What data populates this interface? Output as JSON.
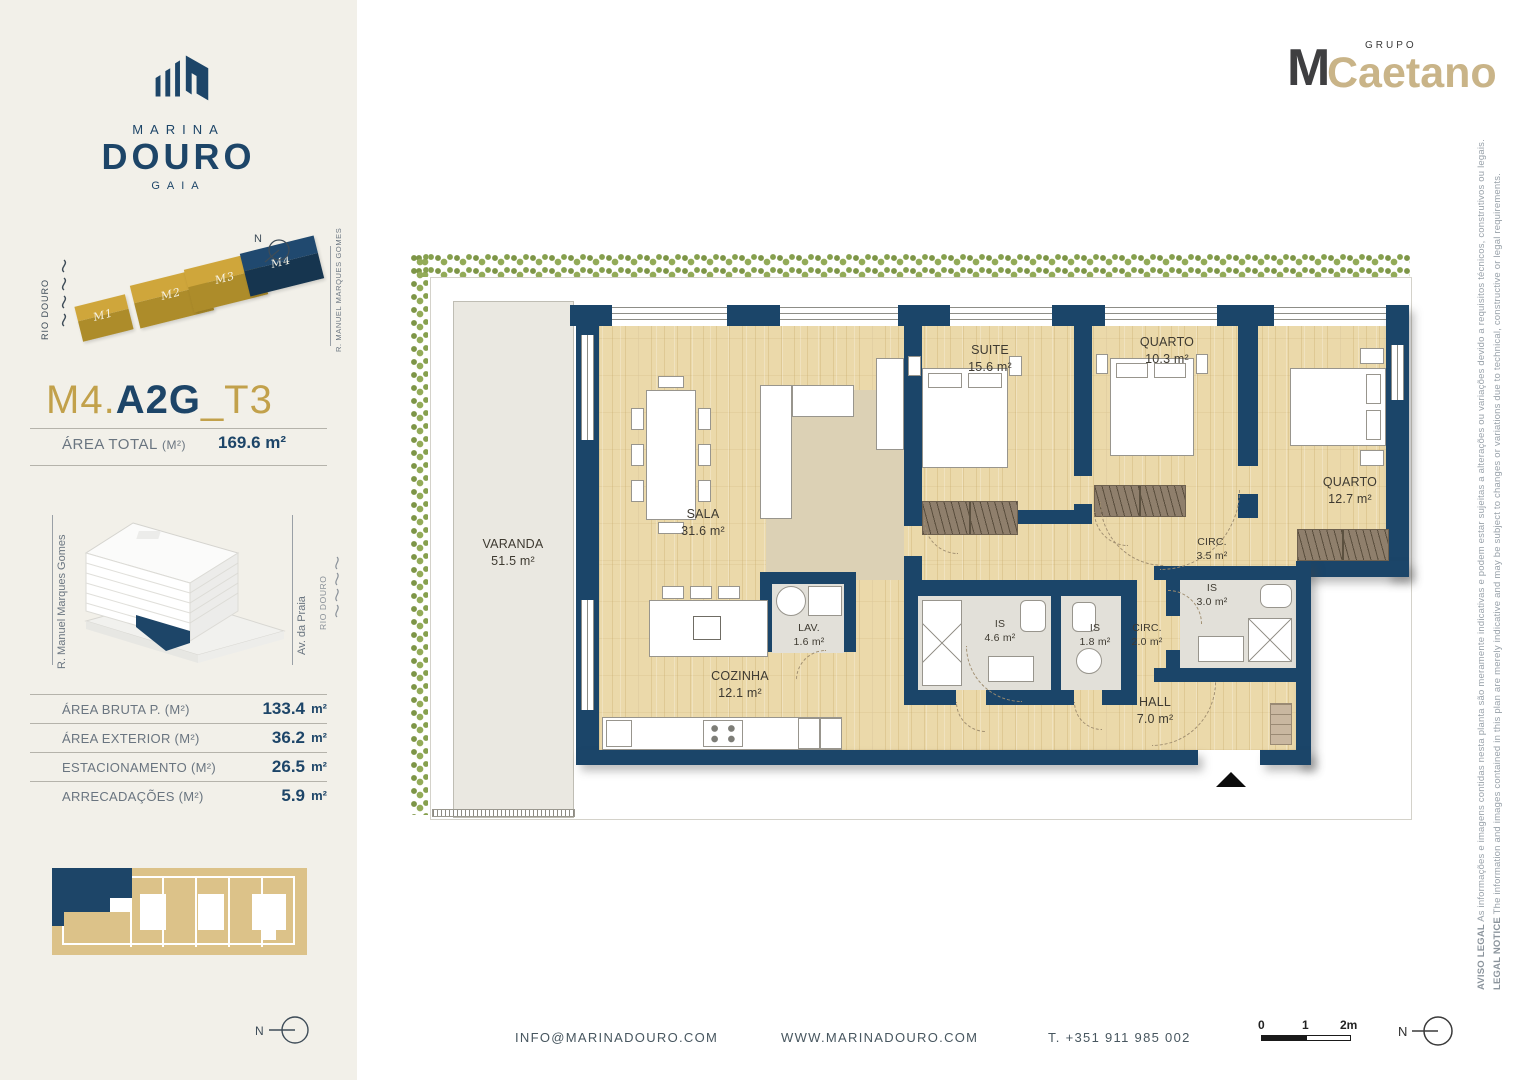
{
  "brand": {
    "name_top": "MARINA",
    "name_main": "DOURO",
    "name_sub": "GAIA"
  },
  "group_logo": {
    "top": "GRUPO",
    "m": "M",
    "name": "Caetano"
  },
  "sidebar": {
    "site_diagram": {
      "river": "RIO DOURO",
      "street": "R. MANUEL MARQUES GOMES",
      "north": "N",
      "blocks": [
        {
          "label": "M1"
        },
        {
          "label": "M2"
        },
        {
          "label": "M3"
        },
        {
          "label": "M4"
        }
      ]
    },
    "unit_title": {
      "prefix": "M4.",
      "main": "A2G",
      "suffix": "_T3"
    },
    "area_total": {
      "label": "ÁREA TOTAL",
      "note": "(M²)",
      "value": "169.6 m²"
    },
    "building_diagram": {
      "street_left": "R. Manuel Marques Gomes",
      "street_right": "Av. da Praia",
      "river": "RIO DOURO"
    },
    "areas_table": [
      {
        "label": "ÁREA BRUTA P.  (M²)",
        "value": "133.4",
        "unit": "m²"
      },
      {
        "label": "ÁREA EXTERIOR (M²)",
        "value": "36.2",
        "unit": "m²"
      },
      {
        "label": "ESTACIONAMENTO (M²)",
        "value": "26.5",
        "unit": "m²"
      },
      {
        "label": "ARRECADAÇÕES (M²)",
        "value": "5.9",
        "unit": "m²"
      }
    ],
    "north": "N"
  },
  "floorplan": {
    "rooms": {
      "varanda": {
        "name": "VARANDA",
        "area": "51.5 m²"
      },
      "sala": {
        "name": "SALA",
        "area": "31.6 m²"
      },
      "suite": {
        "name": "SUITE",
        "area": "15.6 m²"
      },
      "quarto1": {
        "name": "QUARTO",
        "area": "10.3 m²"
      },
      "quarto2": {
        "name": "QUARTO",
        "area": "12.7 m²"
      },
      "circ1": {
        "name": "CIRC.",
        "area": "3.5 m²"
      },
      "is1": {
        "name": "IS",
        "area": "3.0 m²"
      },
      "cozinha": {
        "name": "COZINHA",
        "area": "12.1 m²"
      },
      "lav": {
        "name": "LAV.",
        "area": "1.6 m²"
      },
      "is2": {
        "name": "IS",
        "area": "4.6 m²"
      },
      "is3": {
        "name": "IS",
        "area": "1.8 m²"
      },
      "circ2": {
        "name": "CIRC.",
        "area": "2.0 m²"
      },
      "hall": {
        "name": "HALL",
        "area": "7.0 m²"
      }
    }
  },
  "legal": {
    "pt_title": "AVISO LEGAL",
    "pt_text": " As informações e imagens contidas nesta planta são meramente indicativas e podem estar sujeitas a alterações ou variações devido a requisitos técnicos, construtivos ou legais.",
    "en_title": "LEGAL NOTICE",
    "en_text": " The information and images contained in this plan are merely indicative and may be subject to changes or variations due to technical, constructive or legal requirements."
  },
  "footer": {
    "email": "INFO@MARINADOURO.COM",
    "website": "WWW.MARINADOURO.COM",
    "phone": "T. +351 911 985 002",
    "scale": {
      "t0": "0",
      "t1": "1",
      "t2": "2m"
    },
    "north": "N"
  },
  "colors": {
    "navy": "#1d4568",
    "gold": "#c2a14b",
    "cream": "#f2f0e9",
    "wood": "#ebd9aa",
    "hedge_green": "#86a04e",
    "plan_tan": "#dcc289"
  }
}
